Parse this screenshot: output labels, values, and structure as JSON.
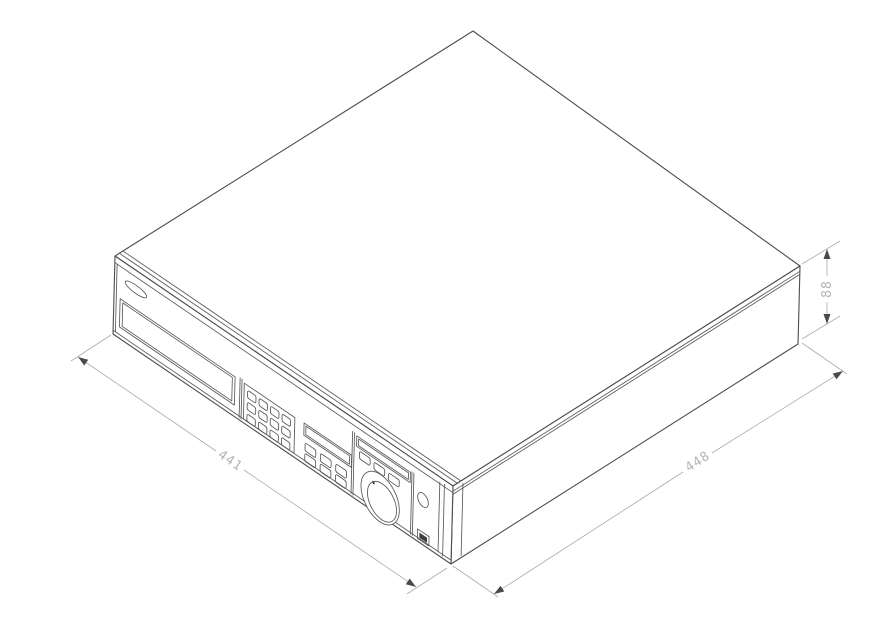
{
  "drawing": {
    "type": "isometric-technical-drawing",
    "subject": "recorder-chassis",
    "dimension_labels": {
      "front_width": "441",
      "side_depth": "448",
      "height": "88"
    },
    "colors": {
      "background": "#ffffff",
      "outline": "#4d4d4d",
      "detail": "#585858",
      "dimension_line": "#ababab",
      "dimension_text": "#b4b4b4",
      "arrowhead": "#4a4a4a"
    },
    "features": [
      "logo-badge",
      "disc-drive-door",
      "numeric-keypad",
      "display-window",
      "control-window",
      "function-buttons",
      "jog-shuttle-dial",
      "power-button",
      "usb-port"
    ]
  }
}
